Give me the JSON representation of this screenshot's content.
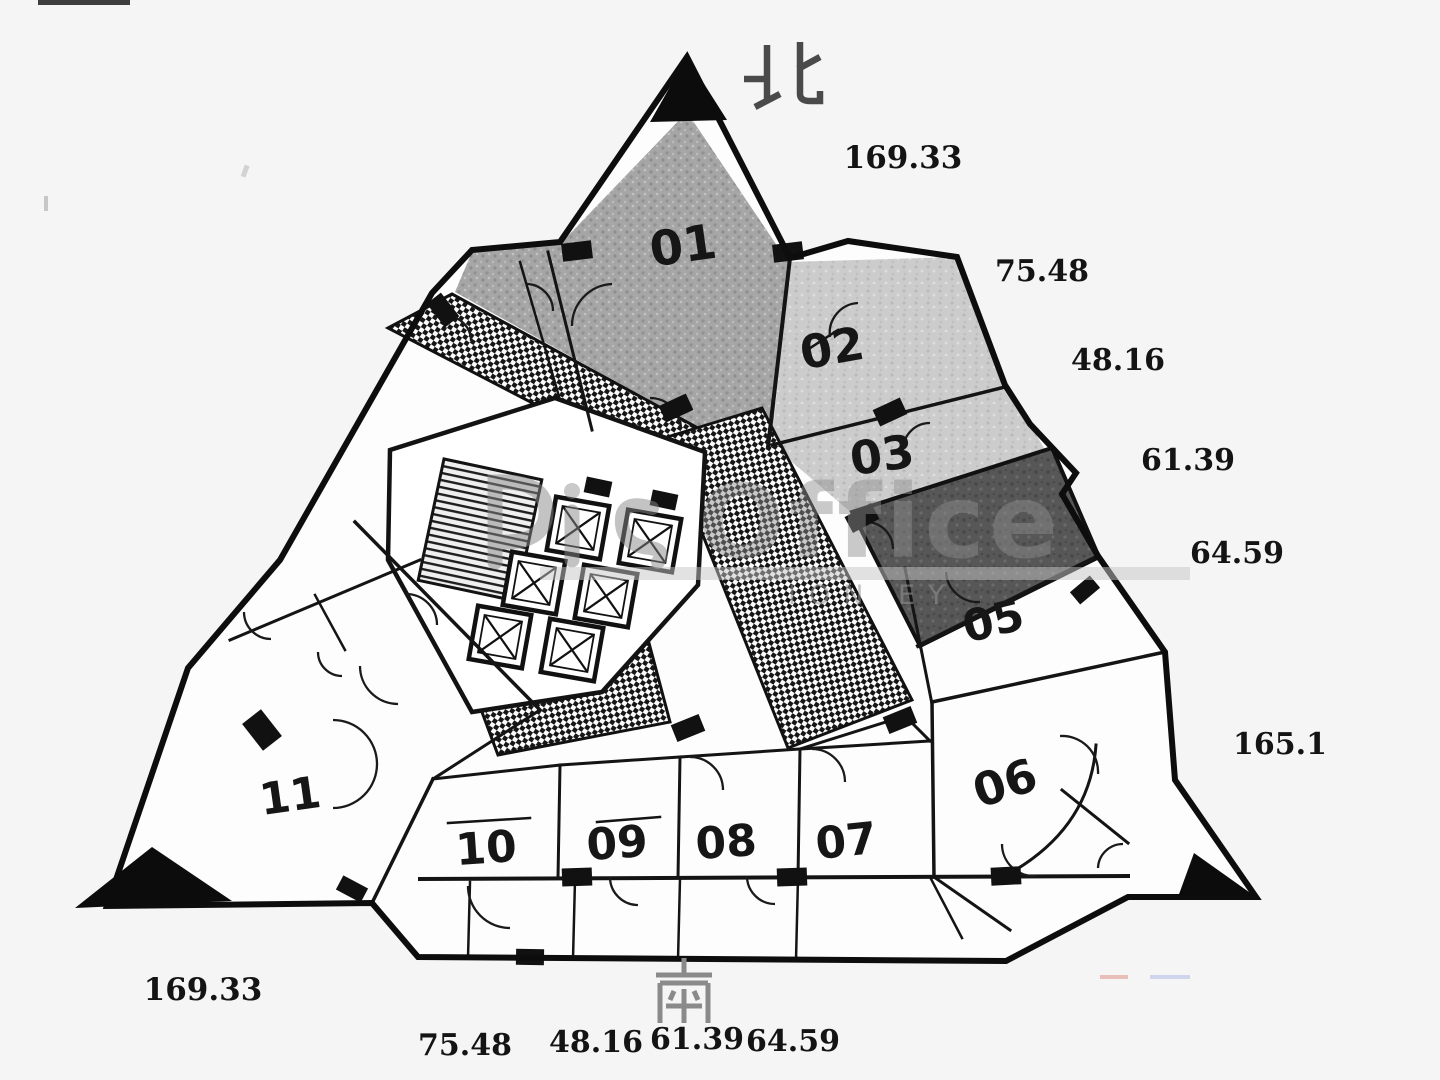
{
  "compass": {
    "north": "北",
    "south": "南"
  },
  "rooms": [
    {
      "number": "01"
    },
    {
      "number": "02"
    },
    {
      "number": "03"
    },
    {
      "number": "05"
    },
    {
      "number": "06"
    },
    {
      "number": "07"
    },
    {
      "number": "08"
    },
    {
      "number": "09"
    },
    {
      "number": "10"
    },
    {
      "number": "11"
    }
  ],
  "area_labels": {
    "right": [
      "169.33",
      "75.48",
      "48.16",
      "61.39",
      "64.59",
      "165.1"
    ],
    "bottom_left": "169.33",
    "bottom": [
      "75.48",
      "48.16",
      "61.39",
      "64.59"
    ]
  },
  "watermark": {
    "text": "Office",
    "subtext": "ION EY"
  }
}
